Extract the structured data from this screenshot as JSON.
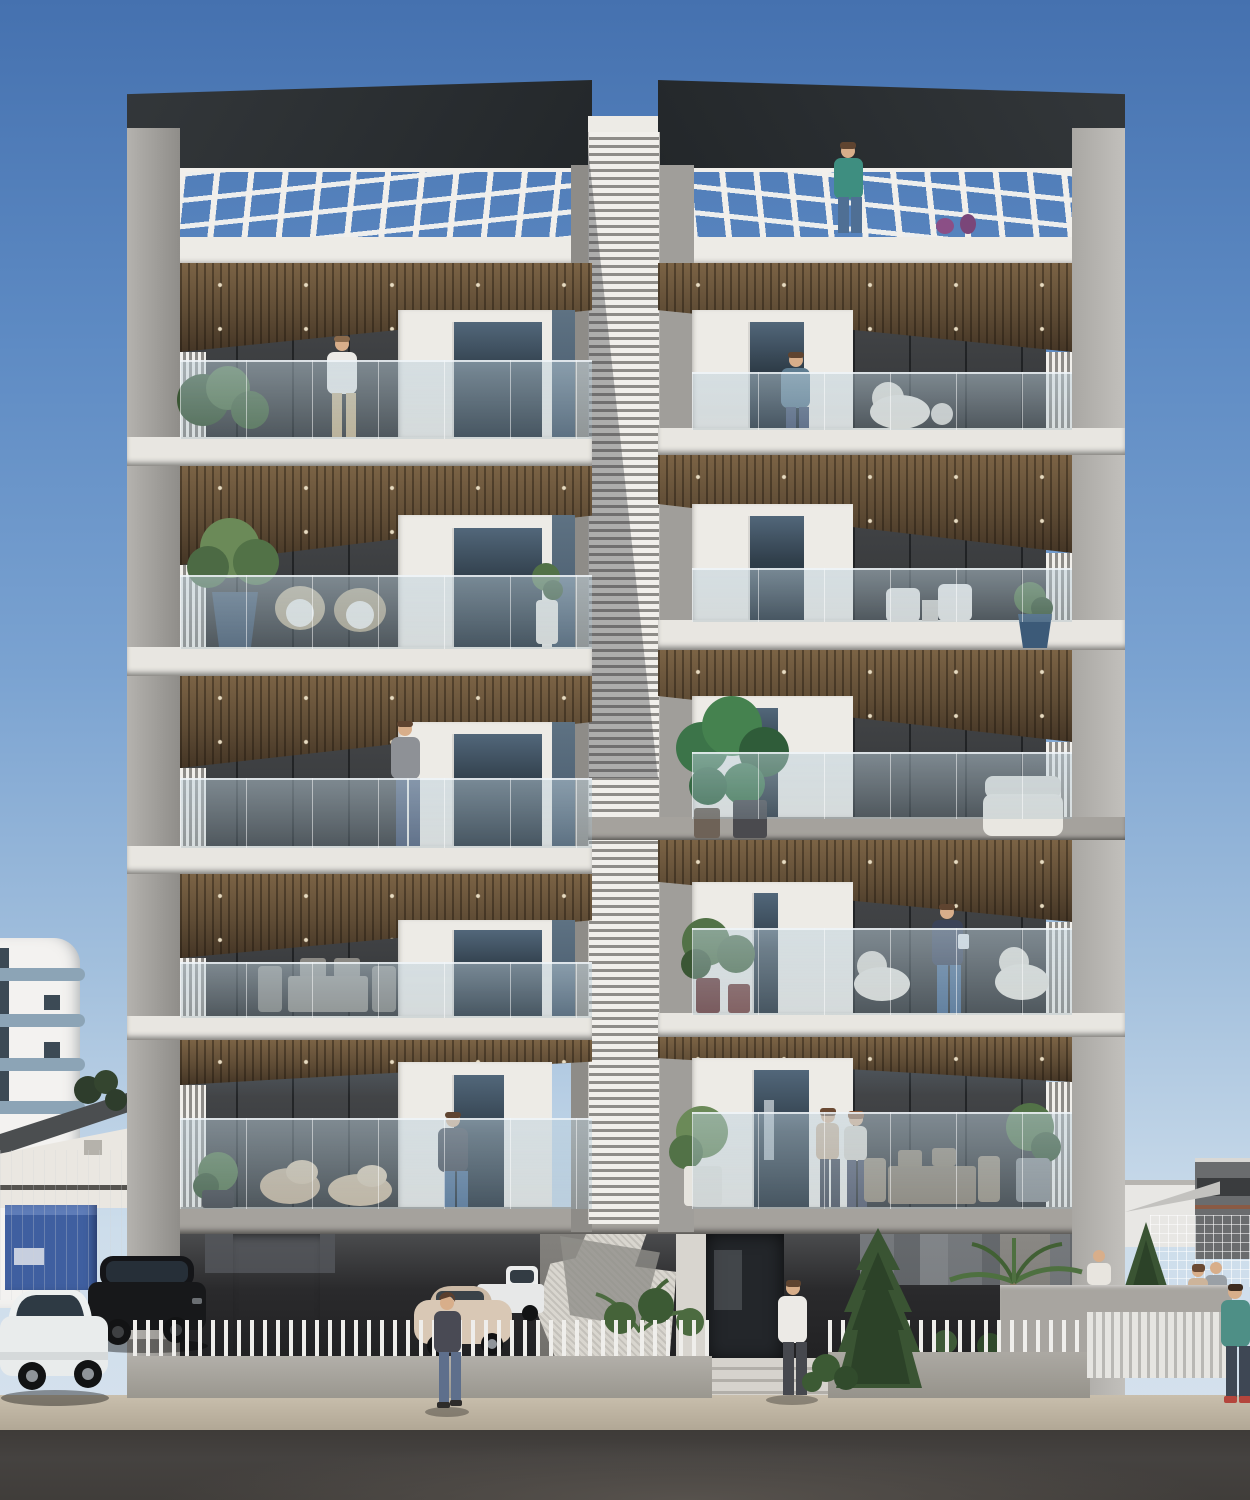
{
  "scene": {
    "type": "architectural 3D rendering",
    "subject": "modern multi-storey residential apartment building, front elevation, daytime clear sky",
    "width_px": 1250,
    "height_px": 1500,
    "building": {
      "wings": 2,
      "residential_floors_per_wing": 5,
      "roof": "open roof terraces with white pergola lattice and glass railing over each wing",
      "core": "central white horizontally-louvered stair core between the wings",
      "balconies": "wood-slat soffits, frameless glass railings, white vertical louver screens at outer edges",
      "ground_level": "open pilotis parking, recessed entrance with steps, white picket fence"
    },
    "people": [
      {
        "location": "right roof terrace",
        "appearance": "man, teal shirt, jeans"
      },
      {
        "location": "left wing floor 2 balcony",
        "appearance": "man, white shirt, khaki trousers"
      },
      {
        "location": "right wing floor 2 balcony",
        "appearance": "man, blue-grey shirt, by window"
      },
      {
        "location": "left wing floor 4 balcony",
        "appearance": "man on phone, grey top, jeans"
      },
      {
        "location": "right wing floor 5 balcony",
        "appearance": "man, navy sweater, reading"
      },
      {
        "location": "right wing floor 6 balcony",
        "appearance": "two women standing together"
      },
      {
        "location": "left wing floor 6 balcony",
        "appearance": "man, dark sweater, jeans"
      },
      {
        "location": "sidewalk left of centre",
        "appearance": "woman walking, dark cardigan, jeans"
      },
      {
        "location": "entrance steps",
        "appearance": "man walking in, white shirt, dark trousers"
      },
      {
        "location": "right background wall",
        "appearance": "man, white shirt (upper body visible)"
      },
      {
        "location": "right background",
        "appearance": "couple standing behind low wall"
      },
      {
        "location": "far right foreground",
        "appearance": "man, teal t-shirt, red shoes"
      }
    ],
    "vehicles": [
      {
        "type": "white SUV",
        "location": "far left, parked"
      },
      {
        "type": "black SUV",
        "location": "behind picket fence, left parking"
      },
      {
        "type": "beige compact car",
        "location": "centre-left parking"
      },
      {
        "type": "white pickup",
        "location": "behind beige car"
      }
    ],
    "vegetation": [
      "balcony potted plants and monstera",
      "two dark conifers",
      "palm trees",
      "shrub rows behind fences"
    ],
    "background": [
      "white apartment block with curved blue-grey balcony bands (left)",
      "warehouse with dark sloped roof (left)",
      "blue site cabin (left)",
      "distant buildings and construction mesh fence (right)"
    ]
  },
  "palette": {
    "sky_top": "#4571af",
    "sky_upper": "#5d8ac3",
    "sky_mid": "#7ba3d1",
    "sky_low": "#a3c0dd",
    "sky_horizon": "#cdddeb",
    "roof_dark": "#33373a",
    "roof_dark2": "#23272a",
    "pier_light": "#bcbab6",
    "pier_mid": "#a09e9a",
    "pier_dark": "#8e8c88",
    "fascia": "#edebe6",
    "slab_white": "#e8e6e1",
    "slab_gray": "#a5a29d",
    "wood": "#5f4c35",
    "wood_dark": "#443525",
    "wood_light": "#7b6345",
    "louver_w": "#f1efeb",
    "louver_g": "#8e8c88",
    "window_top": "#52677a",
    "window_dark": "#2f3d49",
    "interior_top": "#4a4c4f",
    "interior_dark": "#333537",
    "glass_strip": "#5e7283",
    "core_shadow": "rgba(62,66,72,0.38)",
    "recess_top": "#4b4c4e",
    "recess_dark": "#1d1d1f",
    "entr_wall": "#d8d5cf",
    "door_dark": "#23262a",
    "steps": "#cdcac4",
    "artifact": "#d9d6cf",
    "artifact_dark": "#908e8a",
    "sidewalk": "#c9bfad",
    "sidewalk_dark": "#b0a694",
    "road": "#454240",
    "road_light": "#57524d",
    "fence_white": "#efeeeb",
    "fence_base": "#b2afa9",
    "slatfence": "#e6e5e1",
    "lowwall": "#a8a5a0",
    "bgb_white": "#f3f2f0",
    "bgb_band": "#8ca4b6",
    "bgb_win": "#3c4a55",
    "wh_roof": "#4b4e50",
    "wh_wall": "#eae7e1",
    "cabin": "#3f5fa0",
    "cabin_light": "#5e7cb8",
    "distant_dark": "#6a6c6e",
    "distant_white": "#e8e7e4",
    "distant_red": "#8a5a44",
    "metal_roof": "#c3c2bf",
    "foliage": "#527247",
    "foliage_d": "#3a5634",
    "foliage_l": "#6b8a58",
    "conifer": "#3a5433",
    "conifer_d": "#2c4228",
    "palm": "#4e7040",
    "trunk": "#8a7a62",
    "skin": "#d8ae8a",
    "hair_brown": "#5f4430",
    "shirt_teal": "#3e8e80",
    "jeans": "#4f6f94",
    "shirt_white": "#eceae6",
    "pants_khaki": "#c9b48e",
    "shirt_gray": "#8e9196",
    "hoodie_dark": "#41454f",
    "jeans_dark": "#4c5a76",
    "shirt_blue": "#5f7d91",
    "sweater_navy": "#3a4258",
    "top_beige": "#cdb49a",
    "top_cream": "#d9d3c9",
    "cardigan": "#494a54",
    "shoes_red": "#b4453c",
    "teal_tee": "#4e8f86",
    "furn_cream": "#e8e4dc",
    "furn_gray": "#8f8c86",
    "wicker": "#b5a78c",
    "cushion": "#eceae4",
    "lounge": "#c6b196",
    "wood_furn": "#8d806f",
    "pot_blue": "#3c5a78",
    "pot_maroon": "#6e3a38",
    "pot_dark": "#3a3a3e",
    "pot_white": "#e6e4de",
    "car_white": "#e9ecec",
    "car_glass": "#2e3a44",
    "car_black": "#17181a",
    "car_beige": "#d9c8b5",
    "tire": "#121314",
    "rim": "#8f9499",
    "planter_purple": "#8b4f86"
  }
}
